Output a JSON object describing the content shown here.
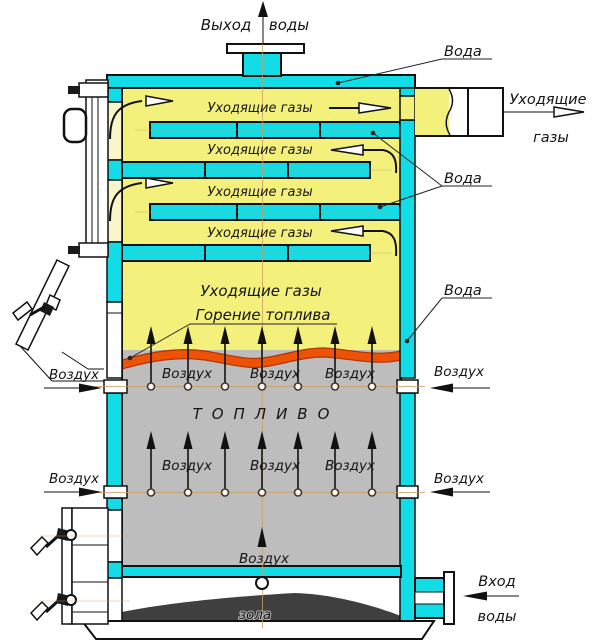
{
  "diagram": {
    "type": "solid-fuel-boiler-cross-section",
    "labels": {
      "water_outlet_word1": "Выход",
      "water_outlet_word2": "воды",
      "water": "Вода",
      "flue_gases": "Уходящие газы",
      "flue_exit_word1": "Уходящие",
      "flue_exit_word2": "газы",
      "combustion": "Горение топлива",
      "air": "Воздух",
      "fuel": "ТОПЛИВО",
      "ash": "зола",
      "water_inlet_word1": "Вход",
      "water_inlet_word2": "воды"
    },
    "colors": {
      "water": "#12dce6",
      "gas": "#f4f07c",
      "gas_pale": "#f9f6c9",
      "fire": "#ec5307",
      "fuel": "#bdbdbd",
      "ash": "#3f3f3f",
      "white": "#ffffff"
    }
  }
}
